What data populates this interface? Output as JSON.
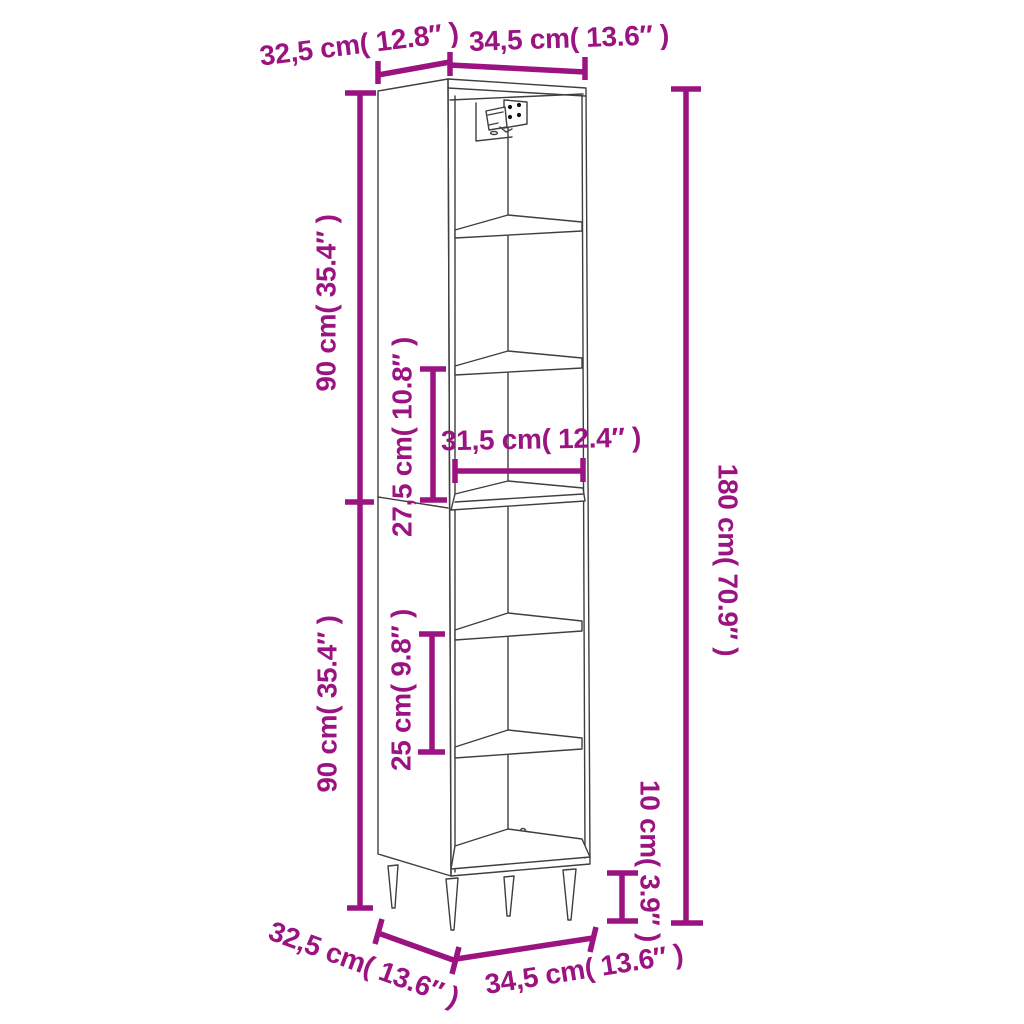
{
  "figure": {
    "kind": "product-dimension-diagram",
    "product": "tall-six-compartment-cabinet-on-legs",
    "colors": {
      "accent": "#9b1380",
      "line": "#3f3f3f",
      "background": "#ffffff"
    },
    "labels": {
      "top_depth": "32,5 cm( 12.8″ )",
      "top_width": "34,5 cm( 13.6″ )",
      "upper_height": "90 cm( 35.4″ )",
      "upper_inner_height": "27,5 cm( 10.8″ )",
      "inner_width": "31,5 cm( 12.4″ )",
      "total_height": "180 cm( 70.9″ )",
      "lower_height": "90 cm( 35.4″ )",
      "lower_inner_height": "25 cm( 9.8″ )",
      "leg_height": "10 cm( 3.9″ )",
      "bottom_depth": "32,5 cm( 13.6″ )",
      "bottom_width": "34,5 cm( 13.6″ )"
    }
  }
}
